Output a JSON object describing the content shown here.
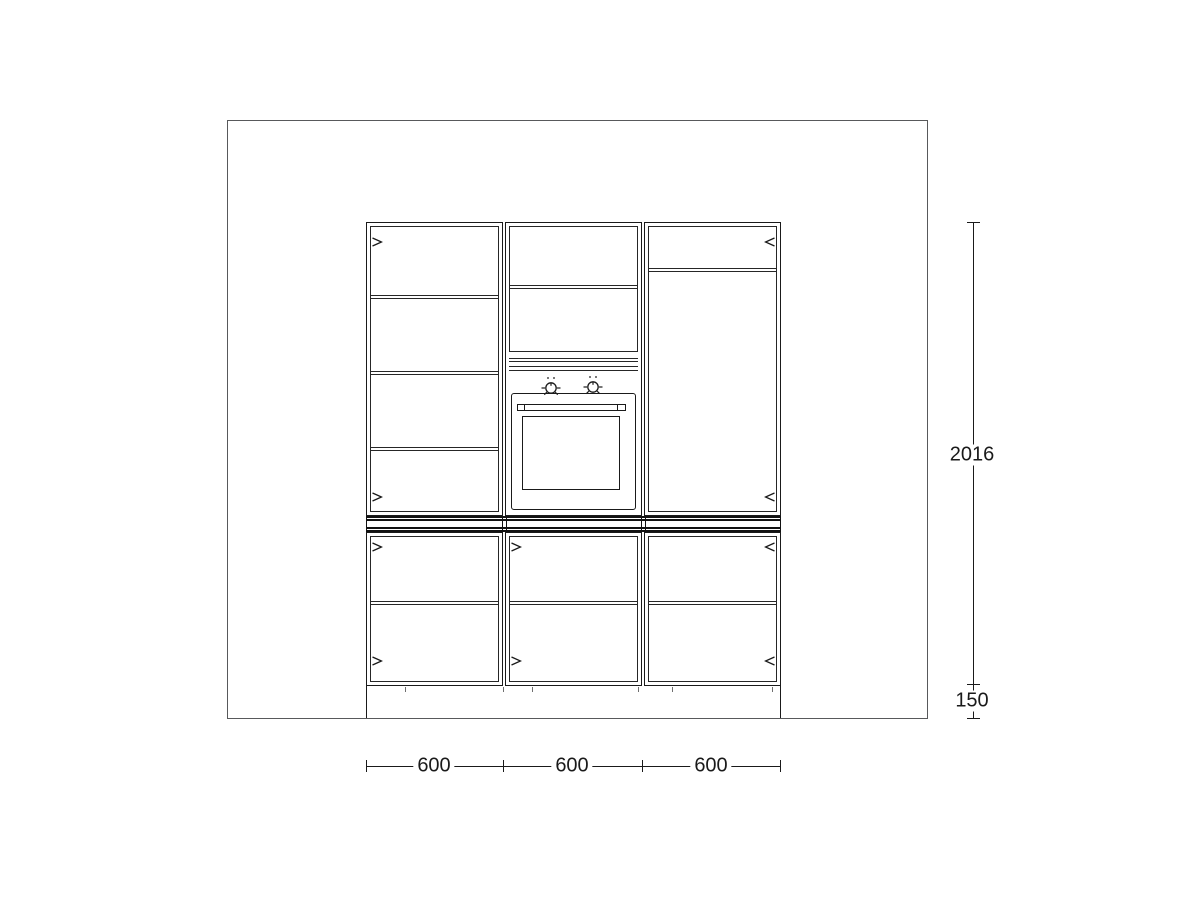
{
  "colors": {
    "ink": "#1a1a1a",
    "wall_line": "#58595b",
    "background": "#ffffff"
  },
  "dimension_labels": {
    "bottom_widths": [
      "600",
      "600",
      "600"
    ],
    "right_heights": {
      "cabinets": "2016",
      "plinth": "150"
    }
  },
  "icons": {
    "door_swing_right": "chevron-right",
    "door_swing_left": "chevron-left",
    "oven_knob": "dial-with-tick-marks"
  }
}
